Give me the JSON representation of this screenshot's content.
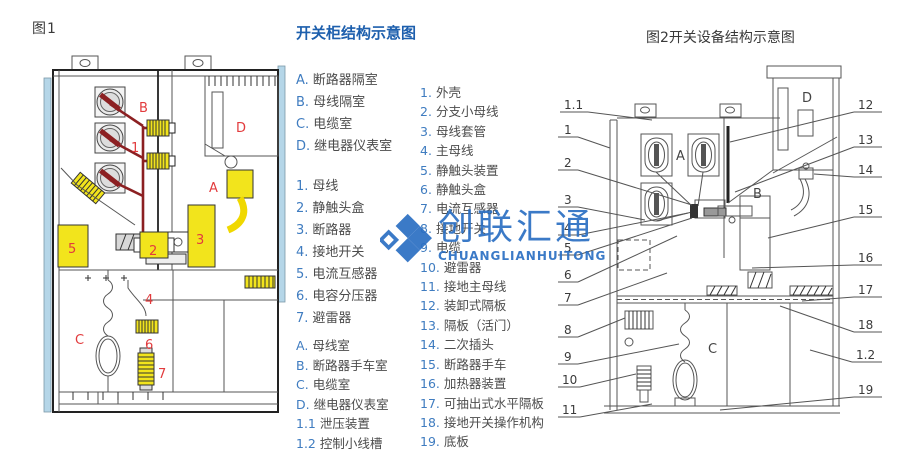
{
  "fig1": {
    "label": "图1",
    "marks": [
      "B",
      "1",
      "D",
      "A",
      "5",
      "2",
      "3",
      "4",
      "C",
      "6",
      "7"
    ]
  },
  "legend": {
    "title": "开关柜结构示意图",
    "compartments": [
      {
        "key": "A.",
        "label": "断路器隔室"
      },
      {
        "key": "B.",
        "label": "母线隔室"
      },
      {
        "key": "C.",
        "label": "电缆室"
      },
      {
        "key": "D.",
        "label": "继电器仪表室"
      }
    ],
    "parts1": [
      {
        "key": "1.",
        "label": "母线"
      },
      {
        "key": "2.",
        "label": "静触头盒"
      },
      {
        "key": "3.",
        "label": "断路器"
      },
      {
        "key": "4.",
        "label": "接地开关"
      },
      {
        "key": "5.",
        "label": "电流互感器"
      },
      {
        "key": "6.",
        "label": "电容分压器"
      },
      {
        "key": "7.",
        "label": "避雷器"
      }
    ],
    "rooms": [
      {
        "key": "A.",
        "label": "母线室"
      },
      {
        "key": "B.",
        "label": "断路器手车室"
      },
      {
        "key": "C.",
        "label": "电缆室"
      },
      {
        "key": "D.",
        "label": "继电器仪表室"
      },
      {
        "key": "1.1",
        "label": "泄压装置"
      },
      {
        "key": "1.2",
        "label": "控制小线槽"
      }
    ],
    "parts2": [
      {
        "key": "1.",
        "label": "外壳"
      },
      {
        "key": "2.",
        "label": "分支小母线"
      },
      {
        "key": "3.",
        "label": "母线套管"
      },
      {
        "key": "4.",
        "label": "主母线"
      },
      {
        "key": "5.",
        "label": "静触头装置"
      },
      {
        "key": "6.",
        "label": "静触头盒"
      },
      {
        "key": "7.",
        "label": "电流互感器"
      },
      {
        "key": "8.",
        "label": "接地开关"
      },
      {
        "key": "9.",
        "label": "电缆"
      },
      {
        "key": "10.",
        "label": "避雷器"
      },
      {
        "key": "11.",
        "label": "接地主母线"
      },
      {
        "key": "12.",
        "label": "装卸式隔板"
      },
      {
        "key": "13.",
        "label": "隔板（活门）"
      },
      {
        "key": "14.",
        "label": "二次插头"
      },
      {
        "key": "15.",
        "label": "断路器手车"
      },
      {
        "key": "16.",
        "label": "加热器装置"
      },
      {
        "key": "17.",
        "label": "可抽出式水平隔板"
      },
      {
        "key": "18.",
        "label": "接地开关操作机构"
      },
      {
        "key": "19.",
        "label": "底板"
      }
    ]
  },
  "fig2": {
    "title": "图2开关设备结构示意图",
    "letters": [
      "A",
      "B",
      "C",
      "D"
    ],
    "callouts_left": [
      "1.1",
      "1",
      "2",
      "3",
      "4",
      "5",
      "6",
      "7",
      "8",
      "9",
      "10",
      "11"
    ],
    "callouts_right": [
      "12",
      "13",
      "14",
      "15",
      "16",
      "17",
      "18",
      "1.2",
      "19"
    ]
  },
  "watermark": {
    "cn": "创联汇通",
    "en": "CHUANGLIANHUITONG"
  },
  "colors": {
    "title_blue": "#1d5fad",
    "key_blue": "#3f7cc0",
    "watermark_blue": "#2b6fc3",
    "label_red": "#e23b3d",
    "highlight_yellow": "#f2e41c",
    "busbar_darkred": "#8c2022",
    "panel_lightblue": "#b5d6e8"
  }
}
